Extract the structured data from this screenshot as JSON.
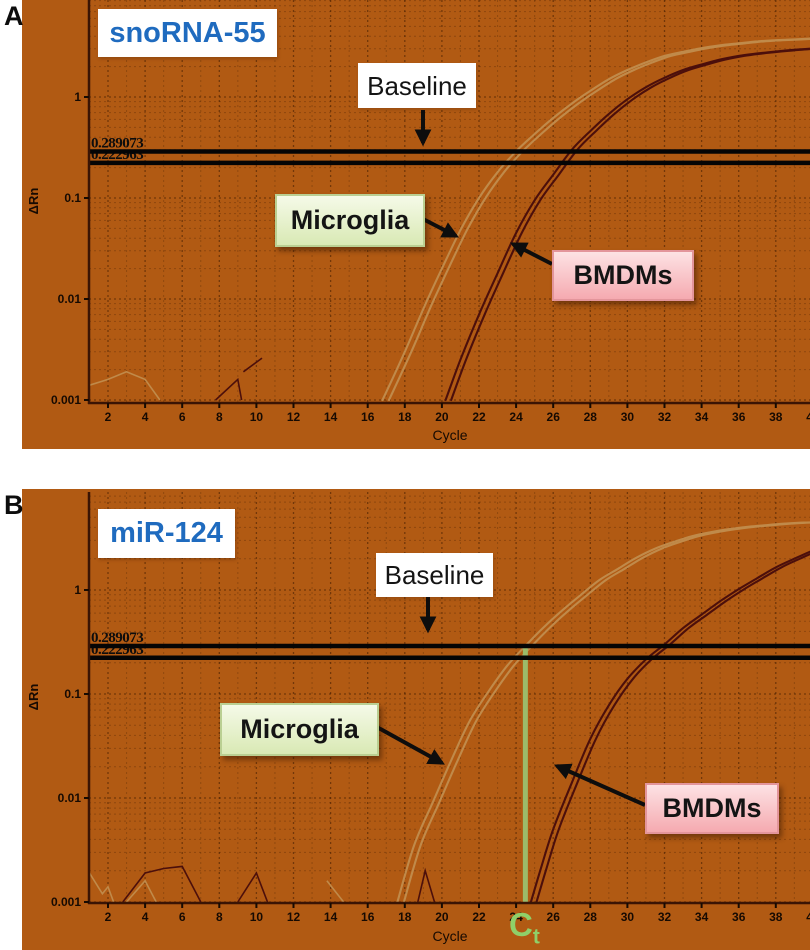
{
  "figure": {
    "panel_letters": [
      "A",
      "B"
    ],
    "colors": {
      "plot_background": "#b15a13",
      "title_blue": "#1f6bbf",
      "ct_green": "#8fd069",
      "ct_line_green": "#9cbb6a",
      "threshold_black": "#050505",
      "microglia_curve": "#c08a4a",
      "bmdm_curve": "#4c0f0b",
      "axis_brown": "#3a1404"
    }
  },
  "chart_data": [
    {
      "type": "line",
      "panel": "A",
      "title": "snoRNA-55",
      "xlabel": "Cycle",
      "ylabel": "ΔRn",
      "y_scale": "log",
      "xlim": [
        1,
        40
      ],
      "ylim": [
        0.001,
        9
      ],
      "x_ticks": [
        2,
        4,
        6,
        8,
        10,
        12,
        14,
        16,
        18,
        20,
        22,
        24,
        26,
        28,
        30,
        32,
        34,
        36,
        38,
        40
      ],
      "y_ticks": [
        1,
        0.1,
        0.01,
        0.001
      ],
      "grid": "dotted",
      "threshold_values": [
        0.289073,
        0.222963
      ],
      "annotations": {
        "baseline": "Baseline",
        "microglia": "Microglia",
        "bmdms": "BMDMs"
      },
      "ct_marker": null,
      "series": [
        {
          "name": "Microglia",
          "color": "#c08a4a",
          "ct_approx": 24,
          "replicate_cycle_offsets": [
            0,
            0.35
          ],
          "points": [
            [
              16.8,
              0.001
            ],
            [
              18,
              0.003
            ],
            [
              19,
              0.008
            ],
            [
              20,
              0.02
            ],
            [
              21,
              0.048
            ],
            [
              22,
              0.1
            ],
            [
              23,
              0.18
            ],
            [
              24,
              0.29
            ],
            [
              25,
              0.43
            ],
            [
              26,
              0.62
            ],
            [
              27,
              0.86
            ],
            [
              28,
              1.15
            ],
            [
              29,
              1.5
            ],
            [
              30,
              1.85
            ],
            [
              31,
              2.2
            ],
            [
              32,
              2.55
            ],
            [
              33,
              2.8
            ],
            [
              34,
              3.05
            ],
            [
              35,
              3.25
            ],
            [
              36,
              3.4
            ],
            [
              37,
              3.55
            ],
            [
              38,
              3.65
            ],
            [
              39,
              3.72
            ],
            [
              40,
              3.8
            ]
          ]
        },
        {
          "name": "BMDMs",
          "color": "#4c0f0b",
          "ct_approx": 27,
          "replicate_cycle_offsets": [
            0,
            0.3
          ],
          "points": [
            [
              20.2,
              0.001
            ],
            [
              21,
              0.0025
            ],
            [
              22,
              0.007
            ],
            [
              23,
              0.018
            ],
            [
              24,
              0.045
            ],
            [
              25,
              0.095
            ],
            [
              26,
              0.17
            ],
            [
              27,
              0.3
            ],
            [
              28,
              0.46
            ],
            [
              29,
              0.68
            ],
            [
              30,
              0.95
            ],
            [
              31,
              1.25
            ],
            [
              32,
              1.55
            ],
            [
              33,
              1.85
            ],
            [
              34,
              2.1
            ],
            [
              35,
              2.35
            ],
            [
              36,
              2.55
            ],
            [
              37,
              2.7
            ],
            [
              38,
              2.82
            ],
            [
              39,
              2.93
            ],
            [
              40,
              3.02
            ]
          ]
        }
      ],
      "noise_traces": [
        {
          "color": "#c08a4a",
          "points": [
            [
              1,
              0.0014
            ],
            [
              2,
              0.0016
            ],
            [
              3,
              0.0019
            ],
            [
              4,
              0.0016
            ],
            [
              4.8,
              0.001
            ]
          ]
        },
        {
          "color": "#4c0f0b",
          "points": [
            [
              7.8,
              0.001
            ],
            [
              9,
              0.0016
            ],
            [
              9.2,
              0.001
            ]
          ]
        },
        {
          "color": "#4c0f0b",
          "points": [
            [
              9.3,
              0.0019
            ],
            [
              10.3,
              0.0026
            ]
          ]
        }
      ]
    },
    {
      "type": "line",
      "panel": "B",
      "title": "miR-124",
      "xlabel": "Cycle",
      "ylabel": "ΔRn",
      "y_scale": "log",
      "xlim": [
        1,
        40
      ],
      "ylim": [
        0.001,
        9
      ],
      "x_ticks": [
        2,
        4,
        6,
        8,
        10,
        12,
        14,
        16,
        18,
        20,
        22,
        24,
        26,
        28,
        30,
        32,
        34,
        36,
        38,
        40
      ],
      "y_ticks": [
        1,
        0.1,
        0.01,
        0.001
      ],
      "grid": "dotted",
      "threshold_values": [
        0.289073,
        0.222963
      ],
      "annotations": {
        "baseline": "Baseline",
        "microglia": "Microglia",
        "bmdms": "BMDMs"
      },
      "ct_marker": {
        "cycle": 24.5,
        "label_base": "C",
        "label_sub": "t"
      },
      "series": [
        {
          "name": "Microglia",
          "color": "#c08a4a",
          "ct_approx": 24.5,
          "replicate_cycle_offsets": [
            0,
            0.35
          ],
          "points": [
            [
              17.6,
              0.001
            ],
            [
              18.5,
              0.0035
            ],
            [
              19.5,
              0.009
            ],
            [
              20.5,
              0.023
            ],
            [
              21.5,
              0.055
            ],
            [
              22.5,
              0.105
            ],
            [
              23.5,
              0.185
            ],
            [
              24.5,
              0.29
            ],
            [
              25.5,
              0.44
            ],
            [
              26.5,
              0.64
            ],
            [
              27.5,
              0.9
            ],
            [
              28.5,
              1.25
            ],
            [
              29.5,
              1.6
            ],
            [
              30.5,
              2.05
            ],
            [
              31.5,
              2.5
            ],
            [
              32.5,
              2.9
            ],
            [
              33.5,
              3.3
            ],
            [
              34.5,
              3.6
            ],
            [
              35.5,
              3.85
            ],
            [
              36.5,
              4.05
            ],
            [
              37.5,
              4.2
            ],
            [
              38.5,
              4.35
            ],
            [
              39.5,
              4.45
            ],
            [
              40.5,
              4.5
            ]
          ]
        },
        {
          "name": "BMDMs",
          "color": "#4c0f0b",
          "ct_approx": 32,
          "replicate_cycle_offsets": [
            0,
            0.3
          ],
          "points": [
            [
              24.8,
              0.001
            ],
            [
              25.3,
              0.002
            ],
            [
              26,
              0.005
            ],
            [
              27,
              0.014
            ],
            [
              28,
              0.037
            ],
            [
              29,
              0.078
            ],
            [
              30,
              0.14
            ],
            [
              31,
              0.215
            ],
            [
              32,
              0.3
            ],
            [
              33,
              0.43
            ],
            [
              34,
              0.58
            ],
            [
              35,
              0.78
            ],
            [
              36,
              1.02
            ],
            [
              37,
              1.3
            ],
            [
              38,
              1.65
            ],
            [
              39,
              2.0
            ],
            [
              40,
              2.4
            ],
            [
              41,
              2.8
            ]
          ]
        }
      ],
      "noise_traces": [
        {
          "color": "#c08a4a",
          "points": [
            [
              1,
              0.0019
            ],
            [
              1.7,
              0.0012
            ],
            [
              2,
              0.0014
            ],
            [
              2.3,
              0.001
            ]
          ]
        },
        {
          "color": "#c08a4a",
          "points": [
            [
              3,
              0.001
            ],
            [
              4,
              0.0016
            ],
            [
              4.6,
              0.001
            ]
          ]
        },
        {
          "color": "#c08a4a",
          "points": [
            [
              13.8,
              0.0016
            ],
            [
              14.7,
              0.001
            ]
          ]
        },
        {
          "color": "#4c0f0b",
          "points": [
            [
              2.8,
              0.001
            ],
            [
              4,
              0.0019
            ],
            [
              5,
              0.0021
            ],
            [
              6,
              0.0022
            ],
            [
              7,
              0.001
            ]
          ]
        },
        {
          "color": "#4c0f0b",
          "points": [
            [
              9,
              0.001
            ],
            [
              10,
              0.0019
            ],
            [
              10.6,
              0.001
            ]
          ]
        },
        {
          "color": "#4c0f0b",
          "points": [
            [
              18.7,
              0.001
            ],
            [
              19.1,
              0.002
            ],
            [
              19.6,
              0.001
            ]
          ]
        }
      ]
    }
  ]
}
